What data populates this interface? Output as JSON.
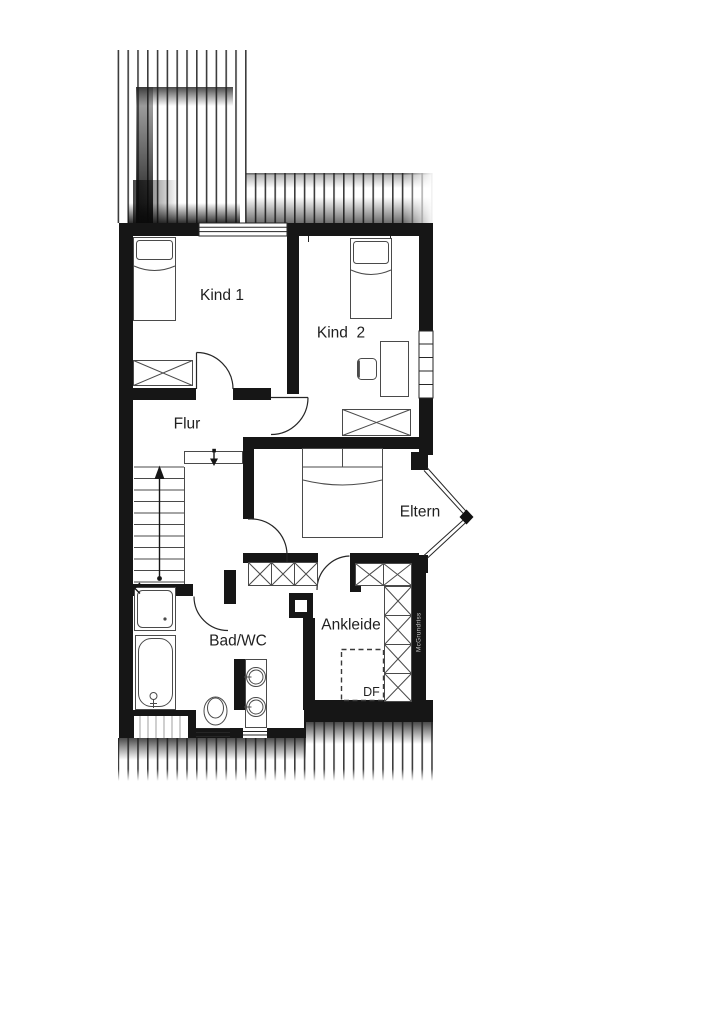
{
  "plan": {
    "type": "upper-floor-plan",
    "background": "#ffffff",
    "colors": {
      "wall": "#161616",
      "furniture_line": "#4a4a4a",
      "door_line": "#262626",
      "hatch_stripe": "#3d3d3d",
      "label_text": "#1f1f1f",
      "watermark_text": "#c9c9c9"
    },
    "rooms": {
      "kind1": {
        "label": "Kind 1"
      },
      "kind2": {
        "label": "Kind  2"
      },
      "flur": {
        "label": "Flur"
      },
      "eltern": {
        "label": "Eltern"
      },
      "badwc": {
        "label": "Bad/WC"
      },
      "ankleide": {
        "label": "Ankleide"
      }
    },
    "annotations": {
      "roof_window_label": "DF",
      "watermark": "McGrundriss"
    }
  }
}
